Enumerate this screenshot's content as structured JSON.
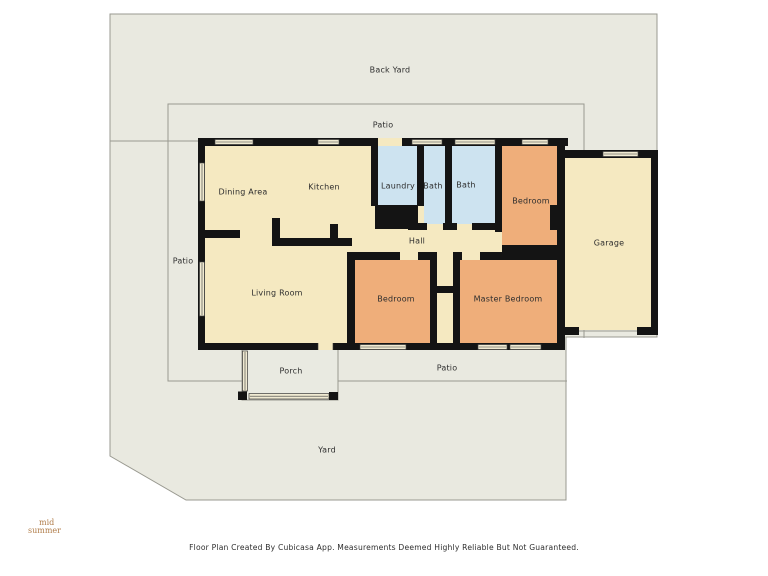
{
  "floor_plan": {
    "labels": {
      "back_yard": "Back Yard",
      "patio_top": "Patio",
      "patio_left": "Patio",
      "patio_bottom": "Patio",
      "dining_area": "Dining Area",
      "kitchen": "Kitchen",
      "laundry": "Laundry",
      "bath_1": "Bath",
      "bath_2": "Bath",
      "bedroom_top": "Bedroom",
      "garage": "Garage",
      "hall": "Hall",
      "living_room": "Living Room",
      "bedroom_bottom": "Bedroom",
      "master_bedroom": "Master Bedroom",
      "porch": "Porch",
      "yard": "Yard"
    },
    "logo": {
      "line1": "mid",
      "line2": "summer"
    },
    "footer": "Floor Plan Created By Cubicasa App. Measurements Deemed Highly Reliable But Not Guaranteed.",
    "colors": {
      "yard": "#e9e9e0",
      "room_cream": "#f5e9c1",
      "room_orange": "#efae7a",
      "room_blue": "#cde3f0",
      "wall": "#141414",
      "boundary_line": "#999990",
      "label_text": "#2e2e2e",
      "logo_text": "#b17d4a"
    }
  }
}
